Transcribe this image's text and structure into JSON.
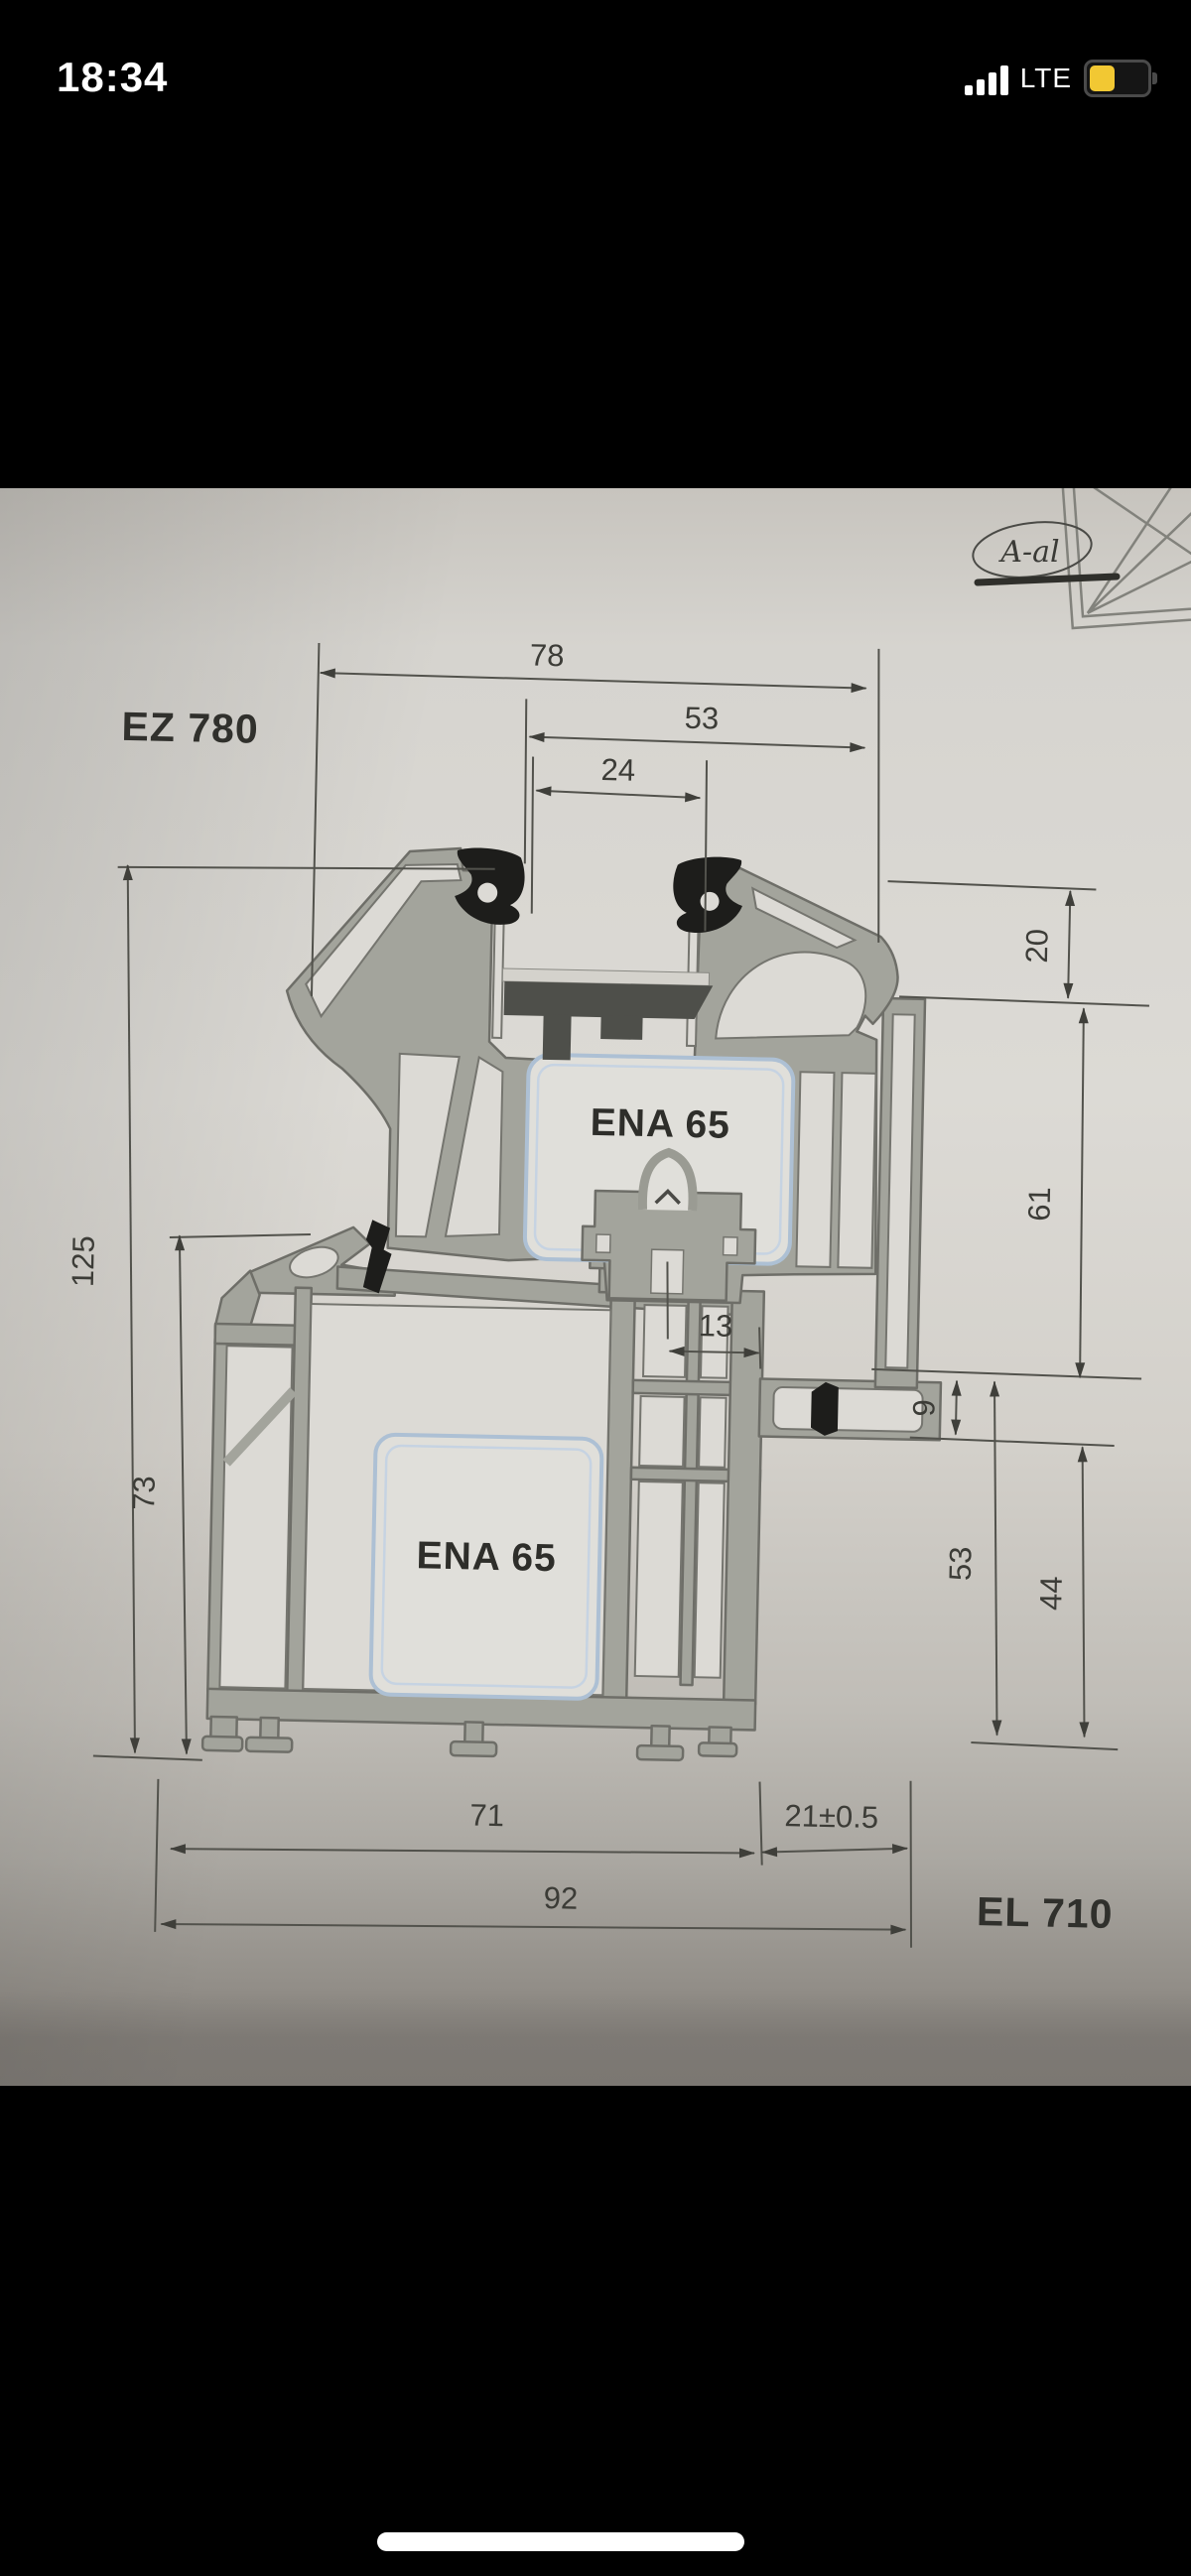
{
  "status_bar": {
    "time": "18:34",
    "network": "LTE",
    "battery_level_percent": 40
  },
  "colors": {
    "battery_yellow": "#f2c833",
    "paper": "#d8d6d1",
    "profile_wall": "#a3a49c",
    "profile_outline": "#6e6e68",
    "chamber_white": "#dcdad5",
    "insulation_outline_blue": "#adc0d4",
    "gasket_black": "#1d1d1b",
    "packer_dark": "#4e4f4a",
    "dimension_line": "#52524c"
  },
  "drawing": {
    "system_labels": {
      "sash": "EZ 780",
      "frame": "EL 710"
    },
    "insulation_labels": {
      "upper": "ENA 65",
      "lower": "ENA 65"
    },
    "signature": "A-al",
    "dimensions": {
      "overall_width": "78",
      "sash_width": "53",
      "glazing_gap": "24",
      "overlap_height": "20",
      "rebate_height": "61",
      "axis_offset": "13",
      "step_height": "9",
      "right_inner_height": "53",
      "right_outer_height": "44",
      "total_height": "125",
      "frame_left_height": "73",
      "frame_width": "71",
      "edge_offset": "21±0.5",
      "base_width": "92"
    }
  }
}
